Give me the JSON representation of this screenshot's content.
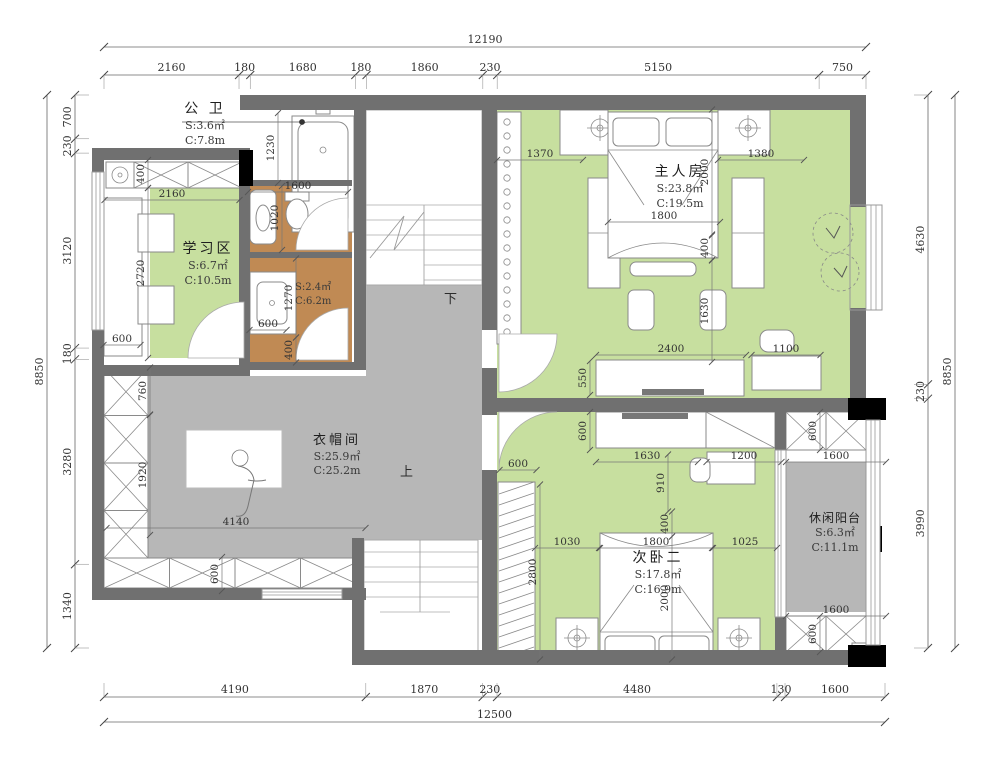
{
  "colors": {
    "wall": "#707070",
    "green": "#c7df9f",
    "gray": "#b7b7b7",
    "brown": "#c08a54",
    "black": "#000000",
    "line": "#8a8a8a",
    "dim": "#333333"
  },
  "chains": {
    "top": [
      "2160",
      "180",
      "1680",
      "180",
      "1860",
      "230",
      "5150",
      "750"
    ],
    "top_total": [
      "12190"
    ],
    "left": [
      "700",
      "230",
      "3120",
      "180",
      "3280",
      "1340"
    ],
    "left_total": [
      "8850"
    ],
    "right": [
      "4630",
      "230",
      "3990"
    ],
    "right_total": [
      "8850"
    ],
    "bottom": [
      "4190",
      "1870",
      "230",
      "4480",
      "130",
      "1600"
    ],
    "bottom_total": [
      "12500"
    ]
  },
  "rooms": [
    {
      "name": "公 卫",
      "area": "S:3.6㎡",
      "circ": "C:7.8m"
    },
    {
      "name": "学习区",
      "area": "S:6.7㎡",
      "circ": "C:10.5m"
    },
    {
      "name": "",
      "area": "S:2.4㎡",
      "circ": "C:6.2m"
    },
    {
      "name": "主人房",
      "area": "S:23.8㎡",
      "circ": "C:19.5m"
    },
    {
      "name": "衣帽间",
      "area": "S:25.9㎡",
      "circ": "C:25.2m"
    },
    {
      "name": "次卧二",
      "area": "S:17.8㎡",
      "circ": "C:16.9m"
    },
    {
      "name": "休闲阳台",
      "area": "S:6.3㎡",
      "circ": "C:11.1m"
    }
  ],
  "stairs": {
    "up": "上",
    "down": "下"
  },
  "interior_dims": [
    {
      "t": "1230",
      "x": 278,
      "y": 148,
      "o": "v",
      "l": 70
    },
    {
      "t": "1600",
      "x": 298,
      "y": 192,
      "o": "h",
      "l": 100
    },
    {
      "t": "1020",
      "x": 282,
      "y": 218,
      "o": "v",
      "l": 64
    },
    {
      "t": "1270",
      "x": 296,
      "y": 298,
      "o": "v",
      "l": 79
    },
    {
      "t": "400",
      "x": 296,
      "y": 350,
      "o": "v",
      "l": 25
    },
    {
      "t": "600",
      "x": 268,
      "y": 330,
      "o": "h",
      "l": 37
    },
    {
      "t": "2160",
      "x": 172,
      "y": 200,
      "o": "h",
      "l": 135
    },
    {
      "t": "400",
      "x": 148,
      "y": 174,
      "o": "v",
      "l": 28
    },
    {
      "t": "2720",
      "x": 148,
      "y": 273,
      "o": "v",
      "l": 170
    },
    {
      "t": "600",
      "x": 122,
      "y": 345,
      "o": "h",
      "l": 37
    },
    {
      "t": "760",
      "x": 150,
      "y": 391,
      "o": "v",
      "l": 47
    },
    {
      "t": "1920",
      "x": 150,
      "y": 475,
      "o": "v",
      "l": 120
    },
    {
      "t": "4140",
      "x": 236,
      "y": 528,
      "o": "h",
      "l": 259
    },
    {
      "t": "600",
      "x": 222,
      "y": 574,
      "o": "v",
      "l": 34
    },
    {
      "t": "1370",
      "x": 540,
      "y": 160,
      "o": "h",
      "l": 86
    },
    {
      "t": "1380",
      "x": 761,
      "y": 160,
      "o": "h",
      "l": 86
    },
    {
      "t": "2000",
      "x": 712,
      "y": 172,
      "o": "v",
      "l": 125
    },
    {
      "t": "1800",
      "x": 664,
      "y": 222,
      "o": "h",
      "l": 112
    },
    {
      "t": "400",
      "x": 712,
      "y": 248,
      "o": "v",
      "l": 25
    },
    {
      "t": "1630",
      "x": 712,
      "y": 311,
      "o": "v",
      "l": 102
    },
    {
      "t": "2400",
      "x": 671,
      "y": 355,
      "o": "h",
      "l": 150
    },
    {
      "t": "550",
      "x": 590,
      "y": 378,
      "o": "v",
      "l": 34
    },
    {
      "t": "1100",
      "x": 786,
      "y": 355,
      "o": "h",
      "l": 69
    },
    {
      "t": "600",
      "x": 590,
      "y": 431,
      "o": "v",
      "l": 38
    },
    {
      "t": "1630",
      "x": 647,
      "y": 462,
      "o": "h",
      "l": 102
    },
    {
      "t": "1200",
      "x": 744,
      "y": 462,
      "o": "h",
      "l": 75
    },
    {
      "t": "910",
      "x": 668,
      "y": 483,
      "o": "v",
      "l": 57
    },
    {
      "t": "400",
      "x": 672,
      "y": 524,
      "o": "v",
      "l": 25
    },
    {
      "t": "600",
      "x": 518,
      "y": 470,
      "o": "h",
      "l": 37
    },
    {
      "t": "1030",
      "x": 567,
      "y": 548,
      "o": "h",
      "l": 64
    },
    {
      "t": "1800",
      "x": 656,
      "y": 548,
      "o": "h",
      "l": 112
    },
    {
      "t": "1025",
      "x": 745,
      "y": 548,
      "o": "h",
      "l": 64
    },
    {
      "t": "2800",
      "x": 540,
      "y": 572,
      "o": "v",
      "l": 175
    },
    {
      "t": "2000",
      "x": 672,
      "y": 598,
      "o": "v",
      "l": 123
    },
    {
      "t": "1600",
      "x": 836,
      "y": 462,
      "o": "h",
      "l": 100
    },
    {
      "t": "1600",
      "x": 836,
      "y": 616,
      "o": "h",
      "l": 100
    },
    {
      "t": "600",
      "x": 820,
      "y": 431,
      "o": "v",
      "l": 38
    },
    {
      "t": "600",
      "x": 820,
      "y": 634,
      "o": "v",
      "l": 36
    }
  ]
}
